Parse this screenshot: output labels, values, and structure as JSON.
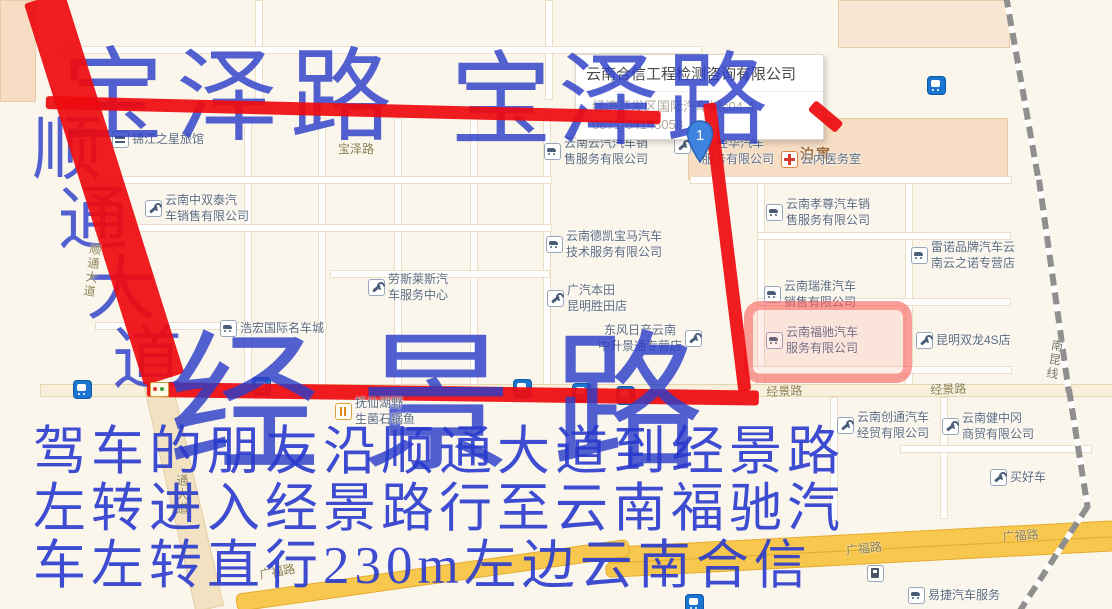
{
  "info_card": {
    "title": "云南合信工程检测咨询有限公司",
    "address": "经济开发区国际汽车城c04-4",
    "phone": "0871-64148058"
  },
  "marker": {
    "label": "1"
  },
  "annotations": {
    "color": "#2c3ec8",
    "route_color": "#ee0b10",
    "baoze_left": "宝泽路",
    "baoze_right": "宝泽路",
    "shuntong_chars": [
      "顺",
      "通",
      "大",
      "道"
    ],
    "jingjing_big": "经景路",
    "directions": [
      "驾车的朋友沿顺通大道到经景路",
      "左转进入经景路行至云南福驰汽",
      "车左转直行230m左边云南合信"
    ]
  },
  "map": {
    "area_labels": {
      "boyu": "泊寓"
    },
    "road_labels": {
      "baoze_small": "宝泽路",
      "jingjing_w": "经景路",
      "jingjing_e": "经景路",
      "guangfu_sw": "广福路",
      "guangfu_mid": "广福路",
      "guangfu_e": "广福路",
      "nankun": "南昆线",
      "tongdadao": "通大道",
      "shuntong_road": "顺通大道"
    },
    "pois": {
      "jinjiang": {
        "l1": "锦江之星旅馆"
      },
      "zhongshuangtai": {
        "l1": "云南中双泰汽",
        "l2": "车销售有限公司"
      },
      "laosilaisi": {
        "l1": "劳斯莱斯汽",
        "l2": "车服务中心"
      },
      "dekai": {
        "l1": "云南德凯宝马汽车",
        "l2": "技术服务有限公司"
      },
      "yunqi": {
        "l1": "云南云汽汽车销",
        "l2": "售服务有限公司"
      },
      "jinghua": {
        "l1": "经华汽车",
        "l2": "服务有限公司"
      },
      "honda": {
        "l1": "广汽本田",
        "l2": "昆明胜田店"
      },
      "nissan": {
        "l1": "东风日产云南",
        "l2": "中升景通专营店"
      },
      "haohong": {
        "l1": "浩宏国际名车城"
      },
      "fuxianhu": {
        "l1": "抚仙湖野",
        "l2": "生菌石锅鱼"
      },
      "clinic": {
        "l1": "云内医务室"
      },
      "xiaozun": {
        "l1": "云南孝尊汽车销",
        "l2": "售服务有限公司"
      },
      "leinuo": {
        "l1": "雷诺品牌汽车云",
        "l2": "南云之诺专营店"
      },
      "ruihuai": {
        "l1": "云南瑞淮汽车",
        "l2": "销售有限公司"
      },
      "fuchi": {
        "l1": "云南福驰汽车",
        "l2": "服务有限公司"
      },
      "shuanglong": {
        "l1": "昆明双龙4S店"
      },
      "chuangtong": {
        "l1": "云南创通汽车",
        "l2": "经贸有限公司"
      },
      "jianzhonggang": {
        "l1": "云南健中冈",
        "l2": "商贸有限公司"
      },
      "maihaoche": {
        "l1": "买好车"
      },
      "yijie": {
        "l1": "易捷汽车服务"
      }
    }
  }
}
